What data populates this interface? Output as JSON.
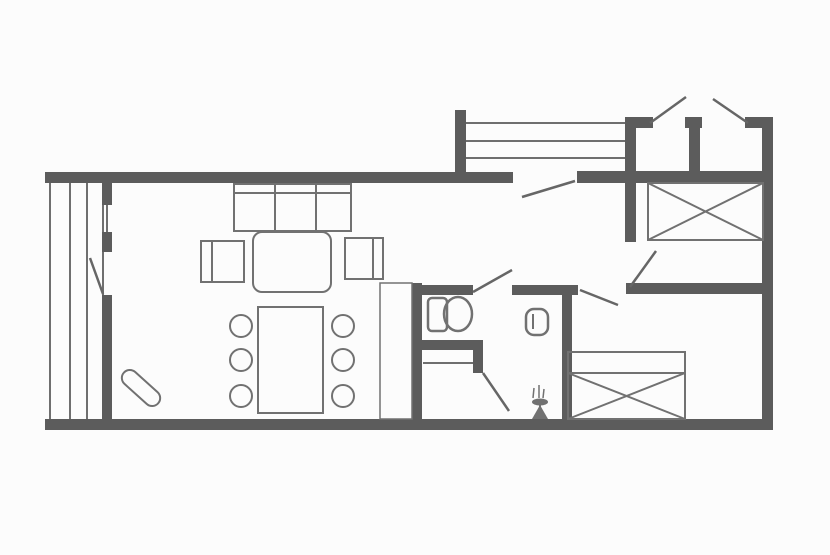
{
  "floorplan": {
    "canvas": {
      "w": 830,
      "h": 555
    },
    "colors": {
      "background": "#fcfcfc",
      "wall": "#5c5c5c",
      "furniture": "#717171",
      "thin": "#6f6f6f",
      "door": "#666666"
    },
    "walls": [
      {
        "n": "outer-top-wall",
        "x": 45,
        "y": 172,
        "w": 468,
        "h": 11
      },
      {
        "n": "hall-top-wall",
        "x": 577,
        "y": 171,
        "w": 196,
        "h": 12
      },
      {
        "n": "porch-left-post",
        "x": 455,
        "y": 110,
        "w": 11,
        "h": 73
      },
      {
        "n": "porch-right-wall",
        "x": 625,
        "y": 117,
        "w": 11,
        "h": 66
      },
      {
        "n": "annex-top-wall-left",
        "x": 625,
        "y": 117,
        "w": 28,
        "h": 11
      },
      {
        "n": "annex-top-wall-mid",
        "x": 685,
        "y": 117,
        "w": 17,
        "h": 11
      },
      {
        "n": "annex-top-wall-right",
        "x": 745,
        "y": 117,
        "w": 28,
        "h": 11
      },
      {
        "n": "annex-divider-wall",
        "x": 689,
        "y": 125,
        "w": 11,
        "h": 52
      },
      {
        "n": "outer-right-wall",
        "x": 762,
        "y": 117,
        "w": 11,
        "h": 313
      },
      {
        "n": "outer-bottom-wall",
        "x": 45,
        "y": 419,
        "w": 728,
        "h": 11
      },
      {
        "n": "living-left-wall-upper",
        "x": 102,
        "y": 183,
        "w": 10,
        "h": 22
      },
      {
        "n": "living-left-wall-mid",
        "x": 102,
        "y": 232,
        "w": 10,
        "h": 20
      },
      {
        "n": "living-left-wall-lower",
        "x": 102,
        "y": 295,
        "w": 10,
        "h": 124
      },
      {
        "n": "bath-left-wall",
        "x": 412,
        "y": 283,
        "w": 10,
        "h": 136
      },
      {
        "n": "bath-top-wall-left",
        "x": 422,
        "y": 285,
        "w": 51,
        "h": 10
      },
      {
        "n": "bath-top-wall-right",
        "x": 512,
        "y": 285,
        "w": 66,
        "h": 10
      },
      {
        "n": "bedroom2-left-wall",
        "x": 562,
        "y": 295,
        "w": 10,
        "h": 124
      },
      {
        "n": "bedrooms-divider-wall",
        "x": 626,
        "y": 283,
        "w": 136,
        "h": 11
      },
      {
        "n": "bedroom1-left-wall",
        "x": 625,
        "y": 183,
        "w": 11,
        "h": 59
      },
      {
        "n": "shower-wall-horizontal",
        "x": 422,
        "y": 340,
        "w": 61,
        "h": 10
      },
      {
        "n": "shower-wall-vertical",
        "x": 473,
        "y": 350,
        "w": 10,
        "h": 23
      }
    ],
    "thin_lines": [
      {
        "n": "terrace-board-1",
        "x1": 50,
        "y1": 183,
        "x2": 50,
        "y2": 419
      },
      {
        "n": "terrace-board-2",
        "x1": 70,
        "y1": 183,
        "x2": 70,
        "y2": 419
      },
      {
        "n": "terrace-board-3",
        "x1": 87,
        "y1": 183,
        "x2": 87,
        "y2": 419
      },
      {
        "n": "terrace-board-4",
        "x1": 103,
        "y1": 183,
        "x2": 103,
        "y2": 419
      },
      {
        "n": "window-glass-line",
        "x1": 107,
        "y1": 205,
        "x2": 107,
        "y2": 232
      },
      {
        "n": "porch-rail-1",
        "x1": 466,
        "y1": 123,
        "x2": 625,
        "y2": 123
      },
      {
        "n": "porch-rail-2",
        "x1": 466,
        "y1": 141,
        "x2": 625,
        "y2": 141
      },
      {
        "n": "porch-rail-3",
        "x1": 466,
        "y1": 158,
        "x2": 625,
        "y2": 158
      },
      {
        "n": "shower-tray-line",
        "x1": 423,
        "y1": 363,
        "x2": 473,
        "y2": 363
      }
    ],
    "door_leaves": [
      {
        "n": "balcony-door-leaf",
        "x1": 90,
        "y1": 258,
        "x2": 103,
        "y2": 294
      },
      {
        "n": "entry-door-leaf",
        "x1": 575,
        "y1": 181,
        "x2": 522,
        "y2": 197
      },
      {
        "n": "annex-left-door-leaf",
        "x1": 650,
        "y1": 123,
        "x2": 686,
        "y2": 97
      },
      {
        "n": "annex-right-door-leaf",
        "x1": 748,
        "y1": 123,
        "x2": 713,
        "y2": 99
      },
      {
        "n": "bedroom1-door-leaf",
        "x1": 630,
        "y1": 287,
        "x2": 656,
        "y2": 251
      },
      {
        "n": "bedroom2-door-leaf",
        "x1": 580,
        "y1": 290,
        "x2": 618,
        "y2": 305
      },
      {
        "n": "bathroom-door-leaf",
        "x1": 473,
        "y1": 292,
        "x2": 512,
        "y2": 270
      },
      {
        "n": "shower-door-leaf",
        "x1": 483,
        "y1": 373,
        "x2": 509,
        "y2": 411
      }
    ],
    "furniture_rects": [
      {
        "n": "sofa",
        "x": 234,
        "y": 184,
        "w": 117,
        "h": 47
      },
      {
        "n": "coffee-table",
        "x": 253,
        "y": 232,
        "w": 78,
        "h": 60,
        "rx": 9
      },
      {
        "n": "armchair-left",
        "x": 201,
        "y": 241,
        "w": 43,
        "h": 41
      },
      {
        "n": "armchair-right",
        "x": 345,
        "y": 238,
        "w": 38,
        "h": 41
      },
      {
        "n": "dining-table",
        "x": 258,
        "y": 307,
        "w": 65,
        "h": 106
      },
      {
        "n": "closet",
        "x": 380,
        "y": 283,
        "w": 32,
        "h": 136,
        "sw": 1.5
      },
      {
        "n": "wood-stove",
        "x": 118,
        "y": 380,
        "w": 46,
        "h": 16,
        "rx": 8,
        "rot": 42,
        "cx": 141,
        "cy": 388
      },
      {
        "n": "toilet-tank",
        "x": 428,
        "y": 298,
        "w": 19,
        "h": 33,
        "rx": 4,
        "sw": 2.5
      },
      {
        "n": "sink-basin",
        "x": 526,
        "y": 309,
        "w": 22,
        "h": 26,
        "rx": 8,
        "sw": 2.5
      },
      {
        "n": "bed2-headboard",
        "x": 568,
        "y": 352,
        "w": 117,
        "h": 21
      }
    ],
    "furniture_lines": [
      {
        "n": "sofa-back-line",
        "x1": 234,
        "y1": 193,
        "x2": 351,
        "y2": 193
      },
      {
        "n": "sofa-divider-1",
        "x1": 275,
        "y1": 184,
        "x2": 275,
        "y2": 231
      },
      {
        "n": "sofa-divider-2",
        "x1": 316,
        "y1": 184,
        "x2": 316,
        "y2": 231
      },
      {
        "n": "armchair-left-back",
        "x1": 212,
        "y1": 241,
        "x2": 212,
        "y2": 282
      },
      {
        "n": "armchair-right-back",
        "x1": 373,
        "y1": 238,
        "x2": 373,
        "y2": 279
      },
      {
        "n": "sink-inner-line",
        "x1": 533,
        "y1": 314,
        "x2": 533,
        "y2": 329
      }
    ],
    "dining_chairs": {
      "r": 11,
      "centers": [
        {
          "cx": 241,
          "cy": 326
        },
        {
          "cx": 241,
          "cy": 360
        },
        {
          "cx": 241,
          "cy": 396
        },
        {
          "cx": 343,
          "cy": 326
        },
        {
          "cx": 343,
          "cy": 360
        },
        {
          "cx": 343,
          "cy": 396
        }
      ]
    },
    "ellipses": [
      {
        "n": "toilet-bowl",
        "cx": 458,
        "cy": 314,
        "rx": 14,
        "ry": 17,
        "sw": 2.5
      }
    ],
    "beds": [
      {
        "n": "bed-top-right",
        "x": 648,
        "y": 183,
        "w": 115,
        "h": 57
      },
      {
        "n": "bed-bottom-right",
        "x": 568,
        "y": 373,
        "w": 117,
        "h": 46
      }
    ],
    "plant": {
      "sprigs": [
        {
          "x1": 534,
          "y1": 388,
          "x2": 533,
          "y2": 398
        },
        {
          "x1": 539,
          "y1": 385,
          "x2": 539,
          "y2": 398
        },
        {
          "x1": 544,
          "y1": 389,
          "x2": 543,
          "y2": 398
        }
      ],
      "bowl": {
        "cx": 540,
        "cy": 402,
        "rx": 8,
        "ry": 3.5
      },
      "stem": {
        "x1": 540,
        "y1": 404,
        "x2": 540,
        "y2": 412
      },
      "base_path": "M532 419 L548 419 L540 405 Z"
    }
  }
}
